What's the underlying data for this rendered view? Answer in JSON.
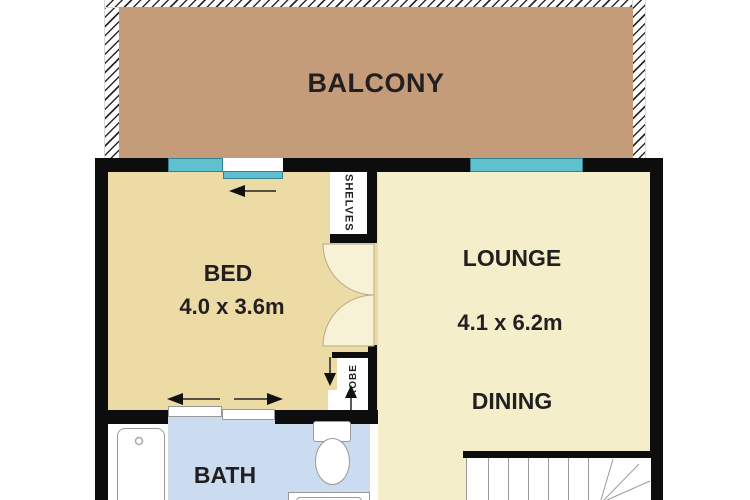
{
  "floorplan": {
    "rooms": {
      "balcony": {
        "label": "BALCONY"
      },
      "bed": {
        "label": "BED",
        "size": "4.0 x 3.6m"
      },
      "lounge": {
        "label": "LOUNGE",
        "size": "4.1 x 6.2m"
      },
      "dining": {
        "label": "DINING"
      },
      "bath": {
        "label": "BATH"
      },
      "shelves": {
        "label": "SHELVES"
      },
      "robe": {
        "label": "ROBE"
      }
    },
    "colors": {
      "balcony": "#c59c79",
      "bed": "#ecdba5",
      "lounge": "#f4efca",
      "bath": "#cbdcf0",
      "window": "#5fc0ce",
      "wall": "#0d0d0d",
      "door": "#f7f2d6",
      "text": "#231f20"
    }
  }
}
